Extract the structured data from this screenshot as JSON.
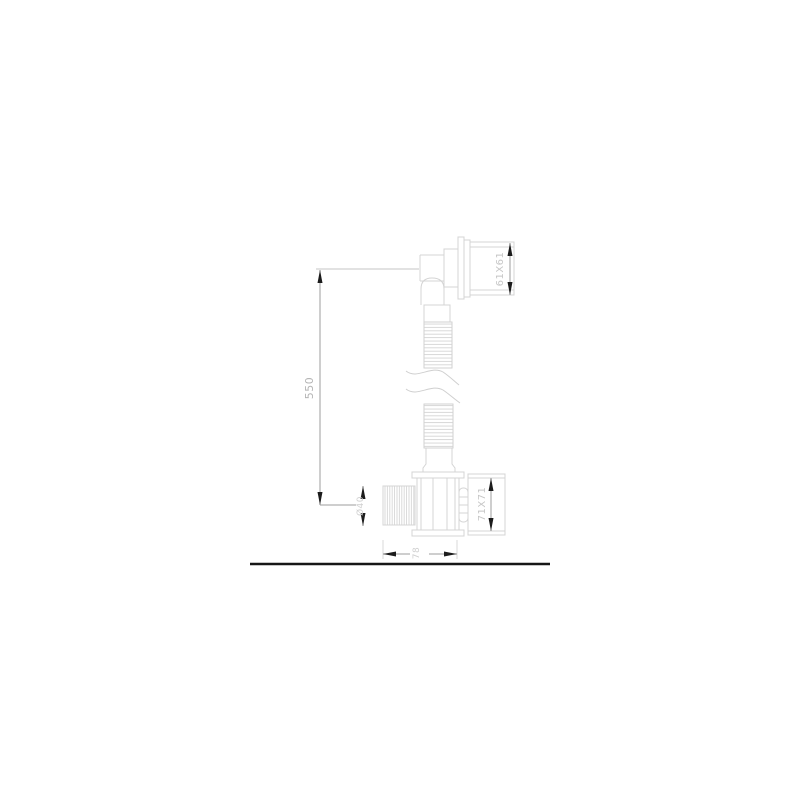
{
  "diagram": {
    "type": "technical-line-drawing",
    "subject": "flexible drain hose with square outlet flange, corrugated tube and threaded trap connector",
    "dimensions": {
      "overall_height": "550",
      "outlet_flange": "61X61",
      "trap_flange": "71X71",
      "thread_size": "Ø40",
      "trap_body_width": "78"
    },
    "parts": {
      "outlet": "elbow-outlet-with-square-flange",
      "hose": "corrugated-flexible-hose",
      "break": "hose-length-break-symbol",
      "trap": "threaded-trap-connector",
      "ground": "floor-reference-line"
    },
    "colors": {
      "background": "#ffffff",
      "part_line": "#d4d4d4",
      "dimension_line": "#9e9e9e",
      "arrow": "#1c1c1c",
      "dimension_text": "#b4b4b4",
      "ground_line": "#161616"
    }
  }
}
